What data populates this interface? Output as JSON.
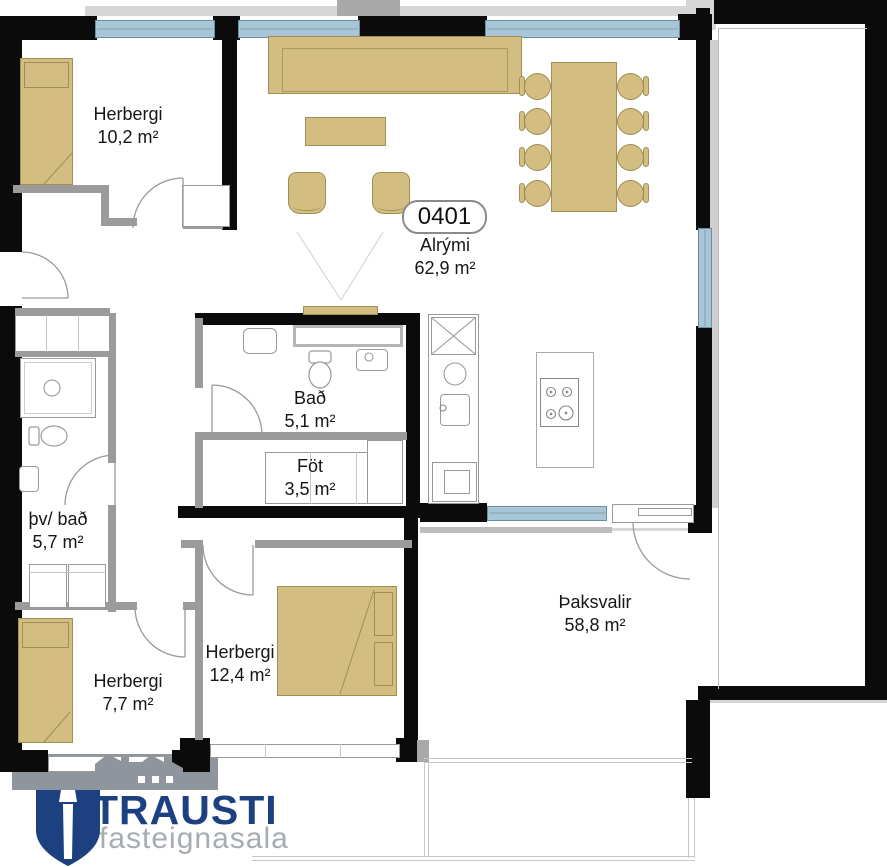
{
  "unit": {
    "number": "0401"
  },
  "rooms": [
    {
      "id": "herbergi-1",
      "name": "Herbergi",
      "area": "10,2 m²"
    },
    {
      "id": "alrymi",
      "name": "Alrými",
      "area": "62,9 m²"
    },
    {
      "id": "bad",
      "name": "Bað",
      "area": "5,1 m²"
    },
    {
      "id": "fot",
      "name": "Föt",
      "area": "3,5 m²"
    },
    {
      "id": "thv-bad",
      "name": "þv/ bað",
      "area": "5,7 m²"
    },
    {
      "id": "herbergi-2",
      "name": "Herbergi",
      "area": "12,4 m²"
    },
    {
      "id": "herbergi-3",
      "name": "Herbergi",
      "area": "7,7 m²"
    },
    {
      "id": "thaksvalir",
      "name": "Þaksvalir",
      "area": "58,8 m²"
    }
  ],
  "logo": {
    "brand": "TRAUSTI",
    "tagline": "fasteignasala"
  },
  "colors": {
    "wall": "#0b0b0b",
    "interior_wall": "#9b9b9b",
    "window": "#a9c6d8",
    "furniture": "#d3bd80",
    "brand_navy": "#1c4080",
    "brand_gray": "#a7acb1"
  }
}
